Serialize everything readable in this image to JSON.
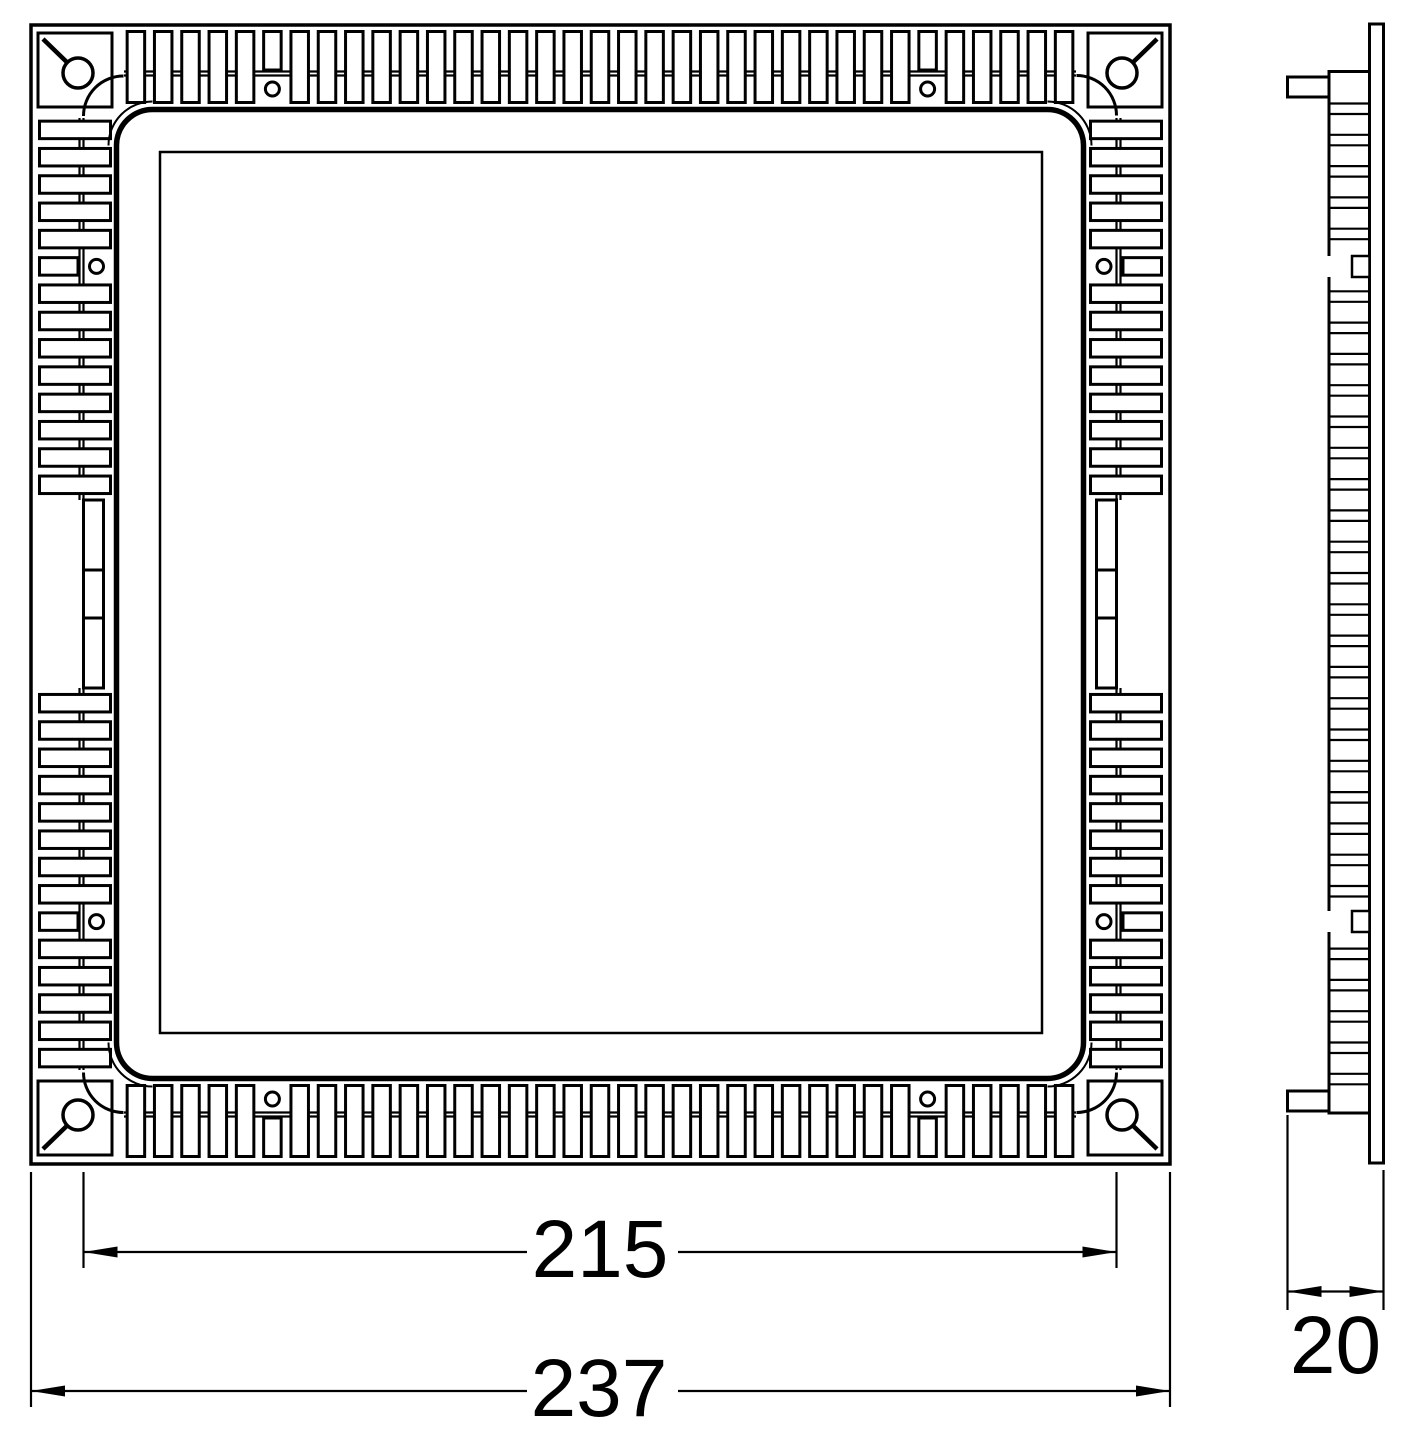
{
  "drawing": {
    "type": "technical-dimension-drawing",
    "views": {
      "front_view": "square panel with perimeter cooling fins, corner spring pivots and mounting screw holes",
      "side_view": "thin profile with horizontal fins, spring clip tabs and front flange plate"
    },
    "dimensions": {
      "overall_width": "237",
      "cutout_width": "215",
      "depth": "20"
    },
    "colors": {
      "line": "#000000",
      "background": "#ffffff"
    }
  }
}
